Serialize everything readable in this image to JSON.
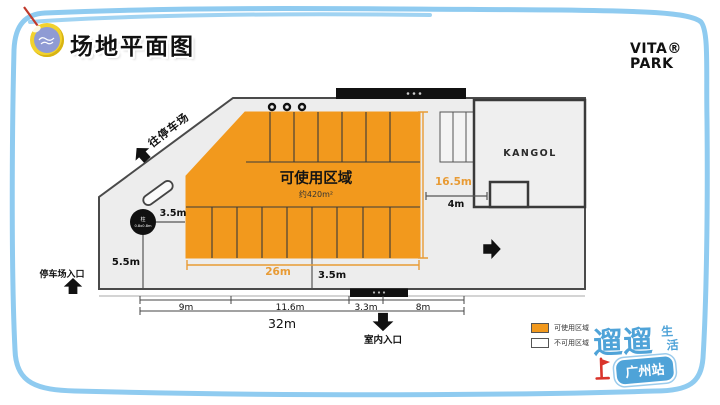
{
  "header": {
    "title": "场地平面图",
    "brand_top": "VITA®",
    "brand_bottom": "PARK"
  },
  "plan": {
    "usable_area": {
      "label": "可使用区域",
      "area": "约420m²"
    },
    "room_label": "KANGOL",
    "column": {
      "label": "柱",
      "size": "0.8x0.8m"
    },
    "to_parking": "往停车场",
    "parking_entrance": "停车场入口",
    "indoor_entrance": "室内入口"
  },
  "dimensions": {
    "column_to_area": "3.5m",
    "left_height": "5.5m",
    "area_height": "16.5m",
    "corridor": "4m",
    "area_width": "26m",
    "area_to_wall": "3.5m",
    "bottom_segments": [
      "9m",
      "11.6m",
      "3.3m",
      "8m"
    ],
    "total_width": "32m"
  },
  "legend": {
    "usable": "可使用区域",
    "unusable": "不可用区域"
  },
  "footer_logo": {
    "name": "遛遛",
    "sub_top": "生",
    "sub_bottom": "活",
    "station": "广州站"
  },
  "colors": {
    "usable_fill": "#F2991D",
    "dim_orange": "#E89B35",
    "plan_fill": "#EDEDED",
    "plan_stroke": "#4A4A4A",
    "border_blue": "#8FCBF0",
    "logo_blue": "#4FA3D8",
    "flag_red": "#D9342B"
  }
}
